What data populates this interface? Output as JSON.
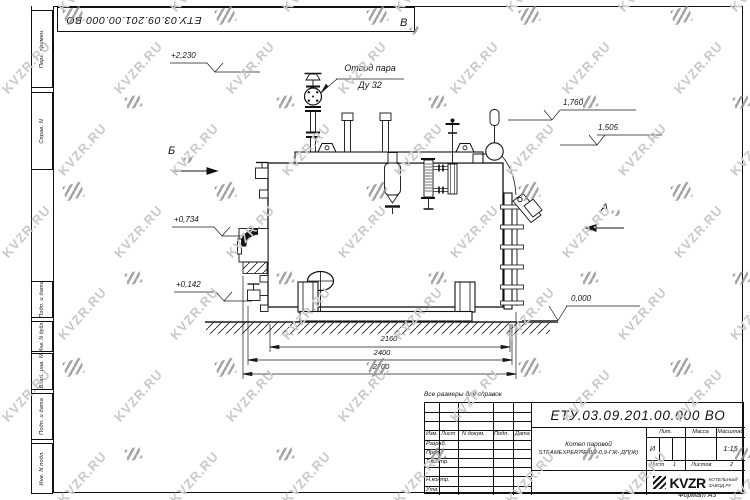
{
  "sheet": {
    "doc_number_flipped": "ЕТУ.03.09.201.00.000  ВО",
    "format_note": "Формат А3",
    "reference_note": "Все размеры для справок",
    "side_columns": [
      "Перв. примен.",
      "Справ. N",
      "Подп. и дата",
      "Инв. N дубл.",
      "Взам. инв. N",
      "Подп. и дата",
      "Инв. N подл."
    ]
  },
  "watermark": {
    "text": "KVZR.RU"
  },
  "drawing": {
    "steam_outlet_line1": "Отвод пара",
    "steam_outlet_line2": "Ду 32",
    "views": {
      "b": "Б",
      "v": "В",
      "a": "А"
    },
    "elevations": {
      "v2230": "+2,230",
      "v0734": "+0,734",
      "v0142": "+0,142",
      "v1760": "1,760",
      "v1505": "1,505",
      "v0000": "0,000"
    },
    "dimensions": {
      "d2160": "2160",
      "d2400": "2400",
      "d2700": "2700"
    }
  },
  "title_block": {
    "doc_number": "ЕТУ.03.09.201.00.000  ВО",
    "product_line1": "Котел паровой",
    "product_line2": "STEAMEXPERT-Е-0,2-0,9-ГЖ- ДП(Ж)",
    "columns_header": [
      "Изм.",
      "Лист",
      "N докум.",
      "Подп.",
      "Дата"
    ],
    "signature_rows": [
      "Разраб.",
      "Пров.",
      "Т.контр.",
      "Н.контр.",
      "Утв."
    ],
    "lit_label": "Лит.",
    "mass_label": "Масса",
    "scale_label": "Масштаб",
    "lit_value": "И",
    "scale_value": "1:15",
    "sheet_label": "Лист",
    "sheet_value": "1",
    "sheets_label": "Листов",
    "sheets_value": "2",
    "company_name": "KVZR",
    "company_sub1": "КОТЕЛЬНЫЙ",
    "company_sub2": "ЗАВОД.РУ"
  }
}
